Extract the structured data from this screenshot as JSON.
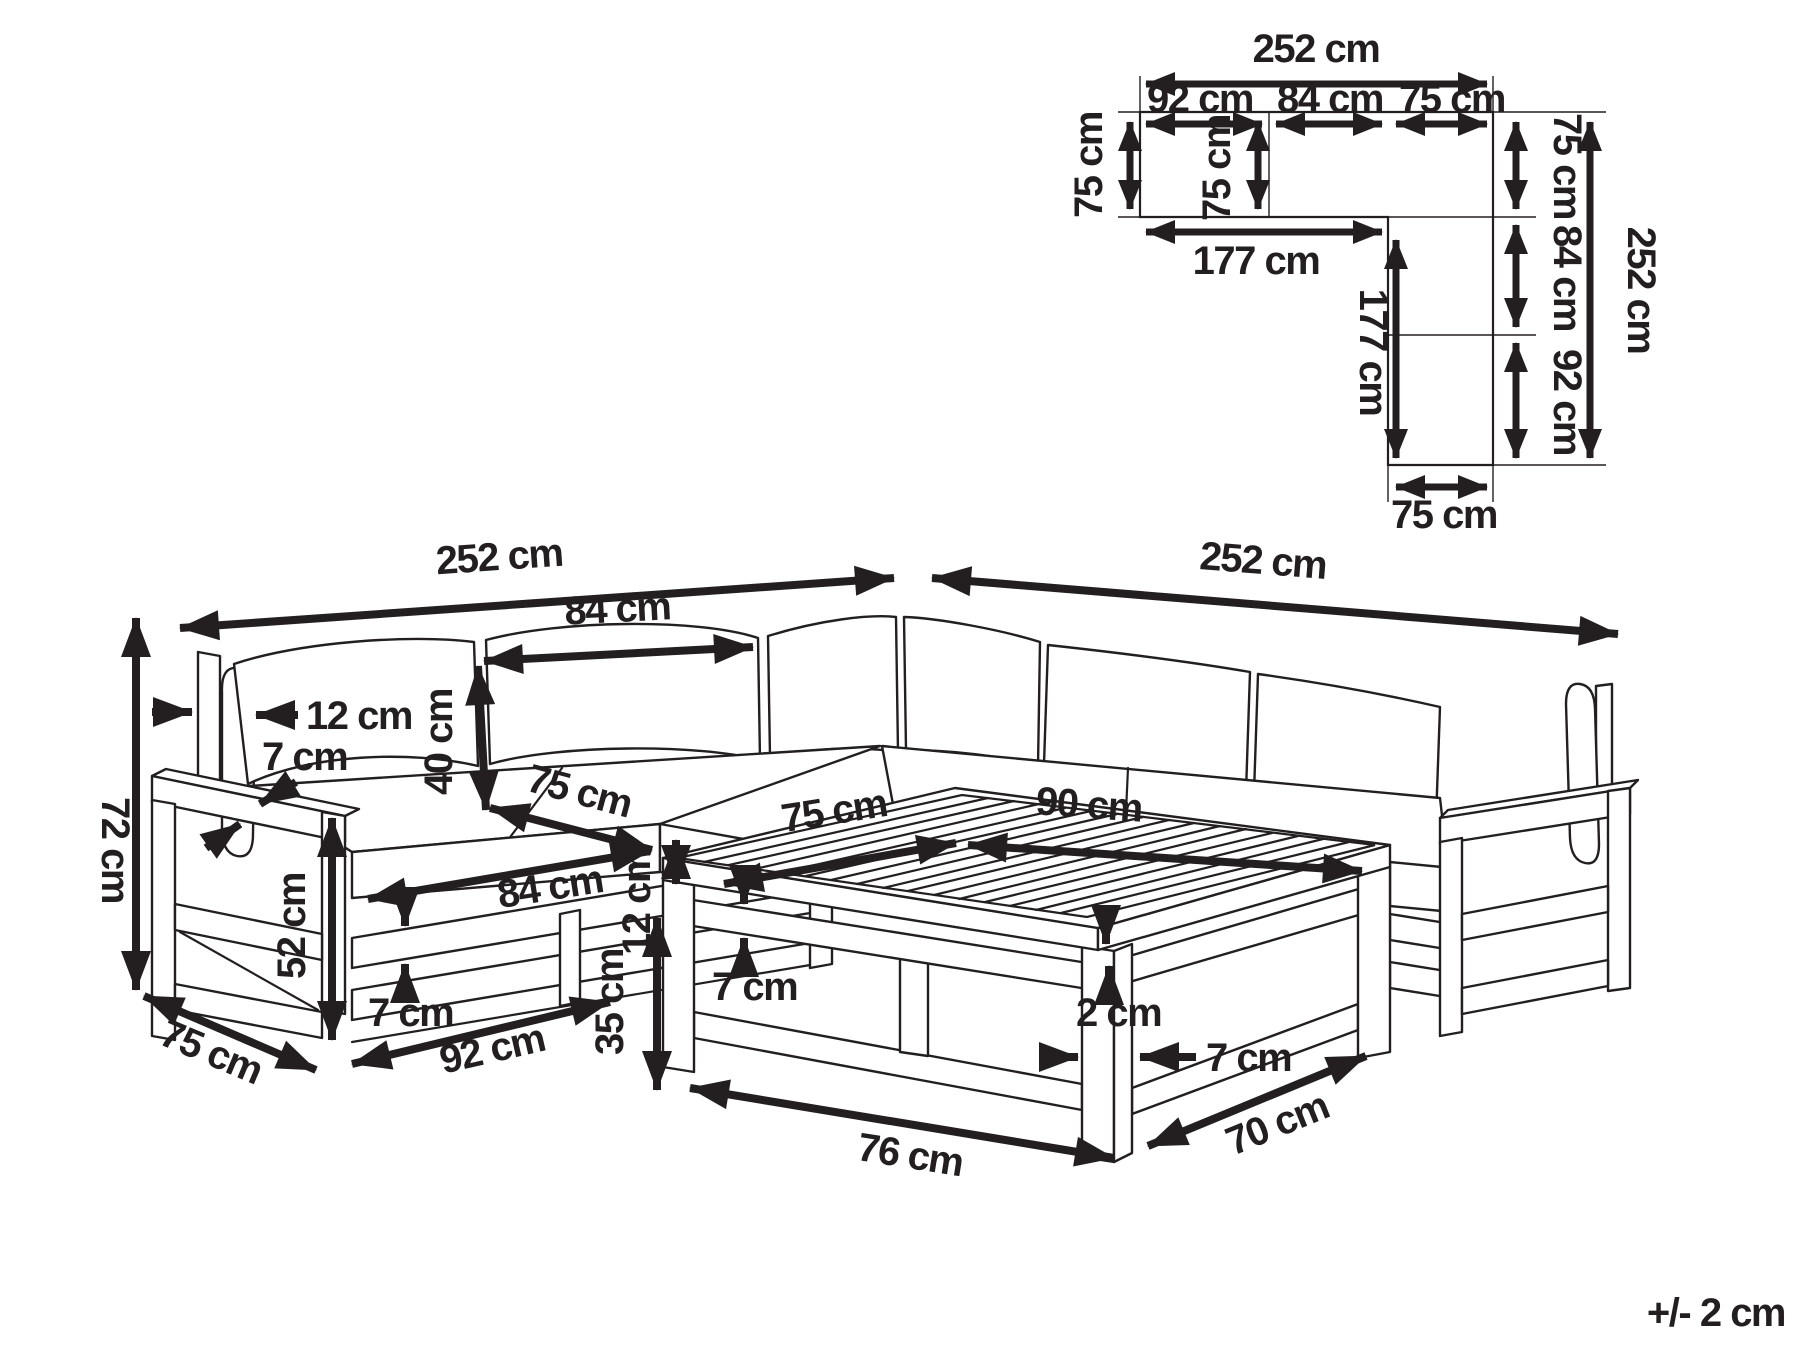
{
  "figure": {
    "tolerance": "+/- 2 cm"
  },
  "plan": {
    "total_width": "252 cm",
    "seg_a": "92 cm",
    "seg_b": "84 cm",
    "seg_c": "75 cm",
    "depth_left": "75 cm",
    "depth_inner": "75 cm",
    "inner_width": "177 cm",
    "inner_height": "177 cm",
    "right_top": "75 cm",
    "right_mid": "84 cm",
    "right_bottom": "92 cm",
    "total_height": "252 cm",
    "bottom_width": "75 cm"
  },
  "main": {
    "total_left": "252 cm",
    "total_right": "252 cm",
    "back_cushion_width": "84 cm",
    "back_thickness": "12 cm",
    "armrest_board": "7 cm",
    "back_height": "40 cm",
    "seat_depth": "75 cm",
    "seat_thickness": "12 cm",
    "seat_width": "75 cm",
    "corner_to_arm": "90 cm",
    "arm_height": "52 cm",
    "seat_front_width": "84 cm",
    "rail_board": "7 cm",
    "base_width": "92 cm",
    "base_depth": "75 cm",
    "total_height": "72 cm",
    "table_height": "35 cm",
    "table_apron": "7 cm",
    "table_gap": "2 cm",
    "table_leg": "7 cm",
    "table_width": "76 cm",
    "table_depth": "70 cm"
  }
}
